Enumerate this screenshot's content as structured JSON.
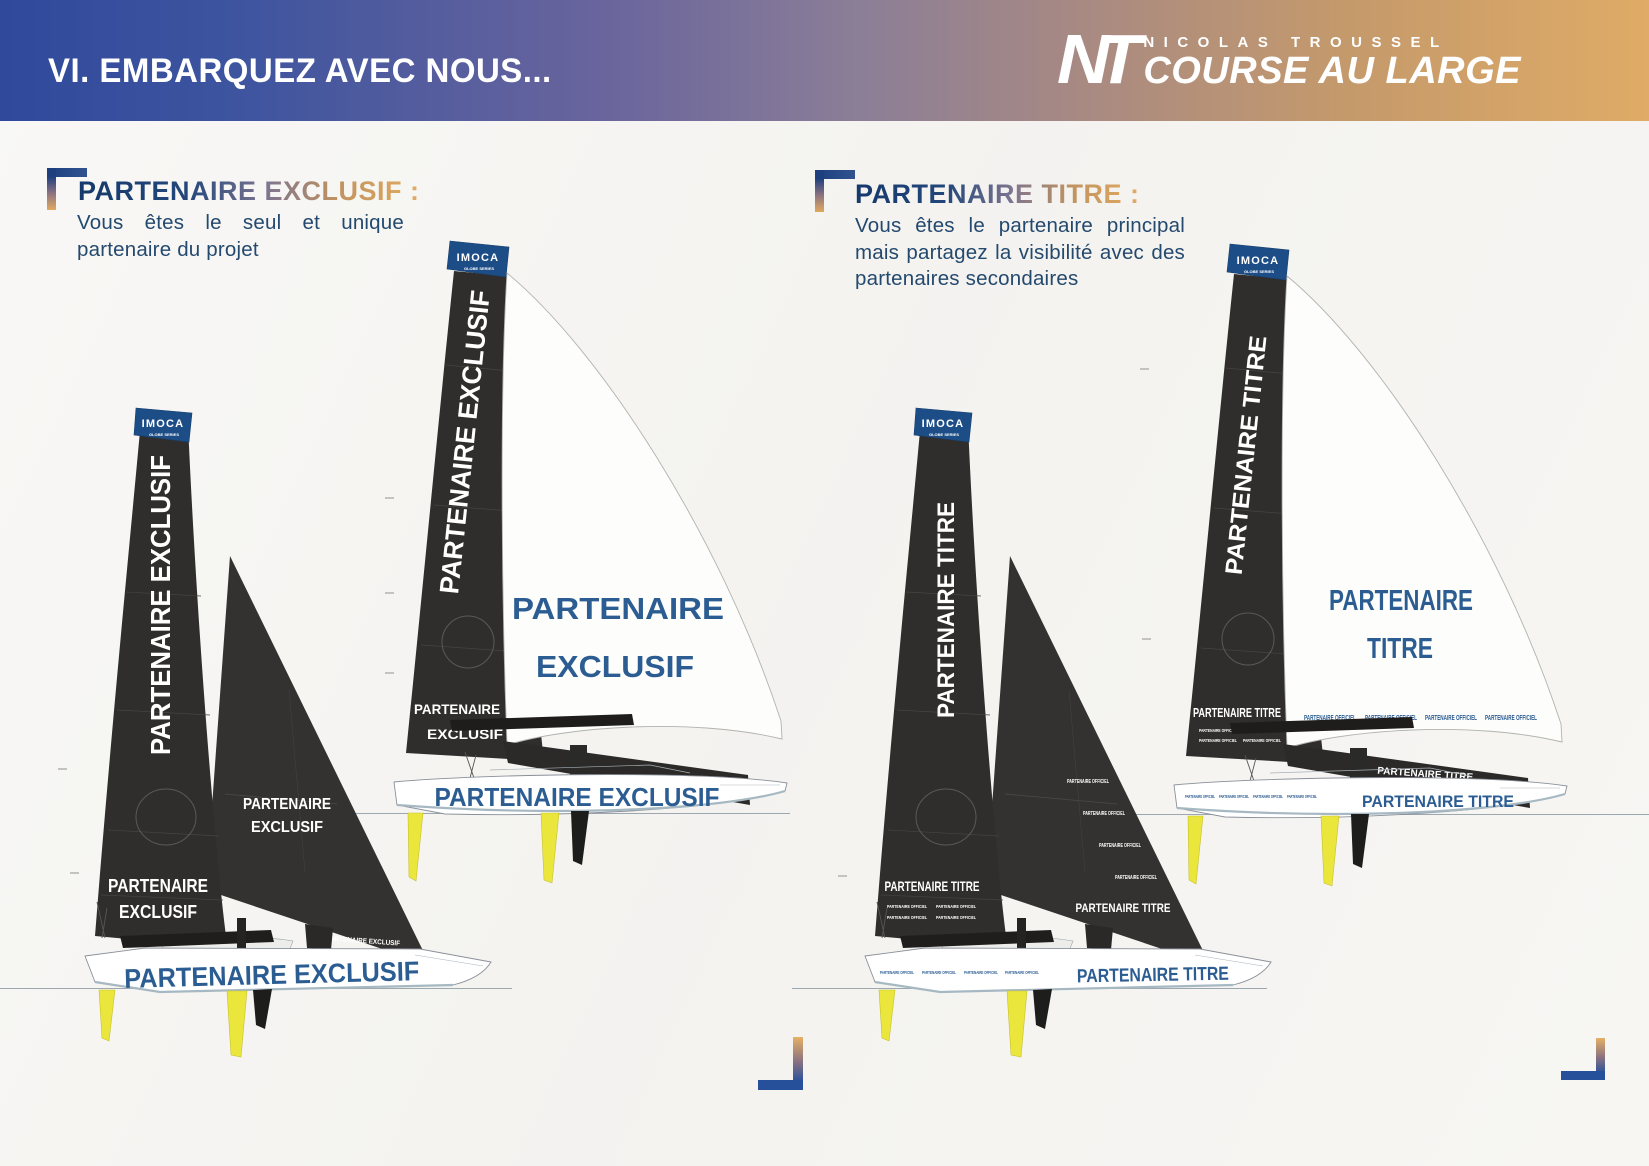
{
  "header": {
    "title": "VI. EMBARQUEZ AVEC NOUS...",
    "logo": {
      "monogram": "NT",
      "name": "NICOLAS TROUSSEL",
      "tagline": "COURSE AU LARGE"
    }
  },
  "imoca": {
    "name": "IMOCA",
    "series": "GLOBE SERIES"
  },
  "sections": {
    "exclusif": {
      "title": "PARTENAIRE EXCLUSIF :",
      "description": "Vous êtes le seul et unique partenaire du projet",
      "brand": "PARTENAIRE EXCLUSIF",
      "brand_l1": "PARTENAIRE",
      "brand_l2": "EXCLUSIF"
    },
    "titre": {
      "title": "PARTENAIRE TITRE :",
      "description": "Vous êtes le partenaire principal mais partagez la visibilité avec des partenaires secondaires",
      "brand": "PARTENAIRE TITRE",
      "brand_l1": "PARTENAIRE",
      "brand_l2": "TITRE",
      "secondary": "PARTENAIRE OFFICIEL"
    }
  },
  "colors": {
    "header_blue": "#30499b",
    "header_tan": "#dfab66",
    "sail_dark": "#2f2e2c",
    "gennaker_white": "#fdfdfc",
    "hull_text_blue": "#2c5d92",
    "keel_yellow": "#ebe63c",
    "imoca_blue": "#1d4d87",
    "body_text_navy": "#24496e",
    "accent_gold": "#e2aa60",
    "accent_navy": "#24448c"
  }
}
